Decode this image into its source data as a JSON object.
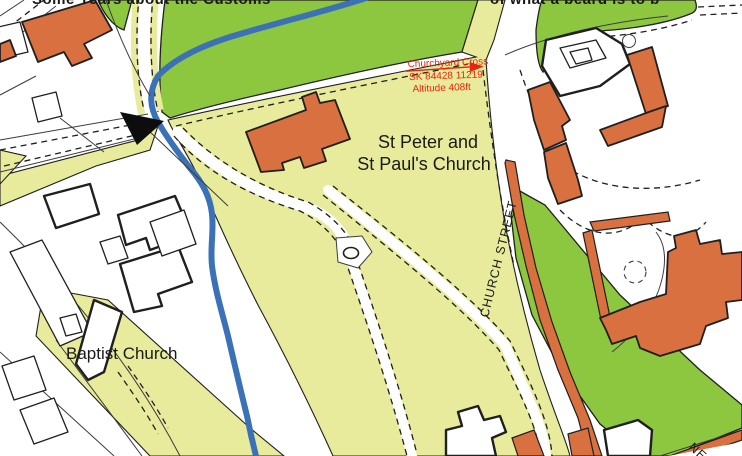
{
  "labels": {
    "church_line1": "St Peter and",
    "church_line2": "St Paul's Church",
    "baptist": "Baptist Church",
    "church_street": "CHURCH STREET",
    "corner_street": "NE",
    "top_left_fragment": "Some Years about the Customs",
    "top_right_fragment": "of what a beard is to b"
  },
  "annotation": {
    "title": "Churchyard Cross",
    "grid_ref": "SK 84428  11219",
    "altitude": "Altitude 408ft"
  },
  "icons": {
    "direction_arrow": "black-triangle-arrow"
  },
  "colors": {
    "green": "#8dc63f",
    "pale": "#e7eb9b",
    "orange": "#d9703f",
    "stream": "#3b71b6",
    "line": "#1f1f1f",
    "red": "#e8250e"
  }
}
